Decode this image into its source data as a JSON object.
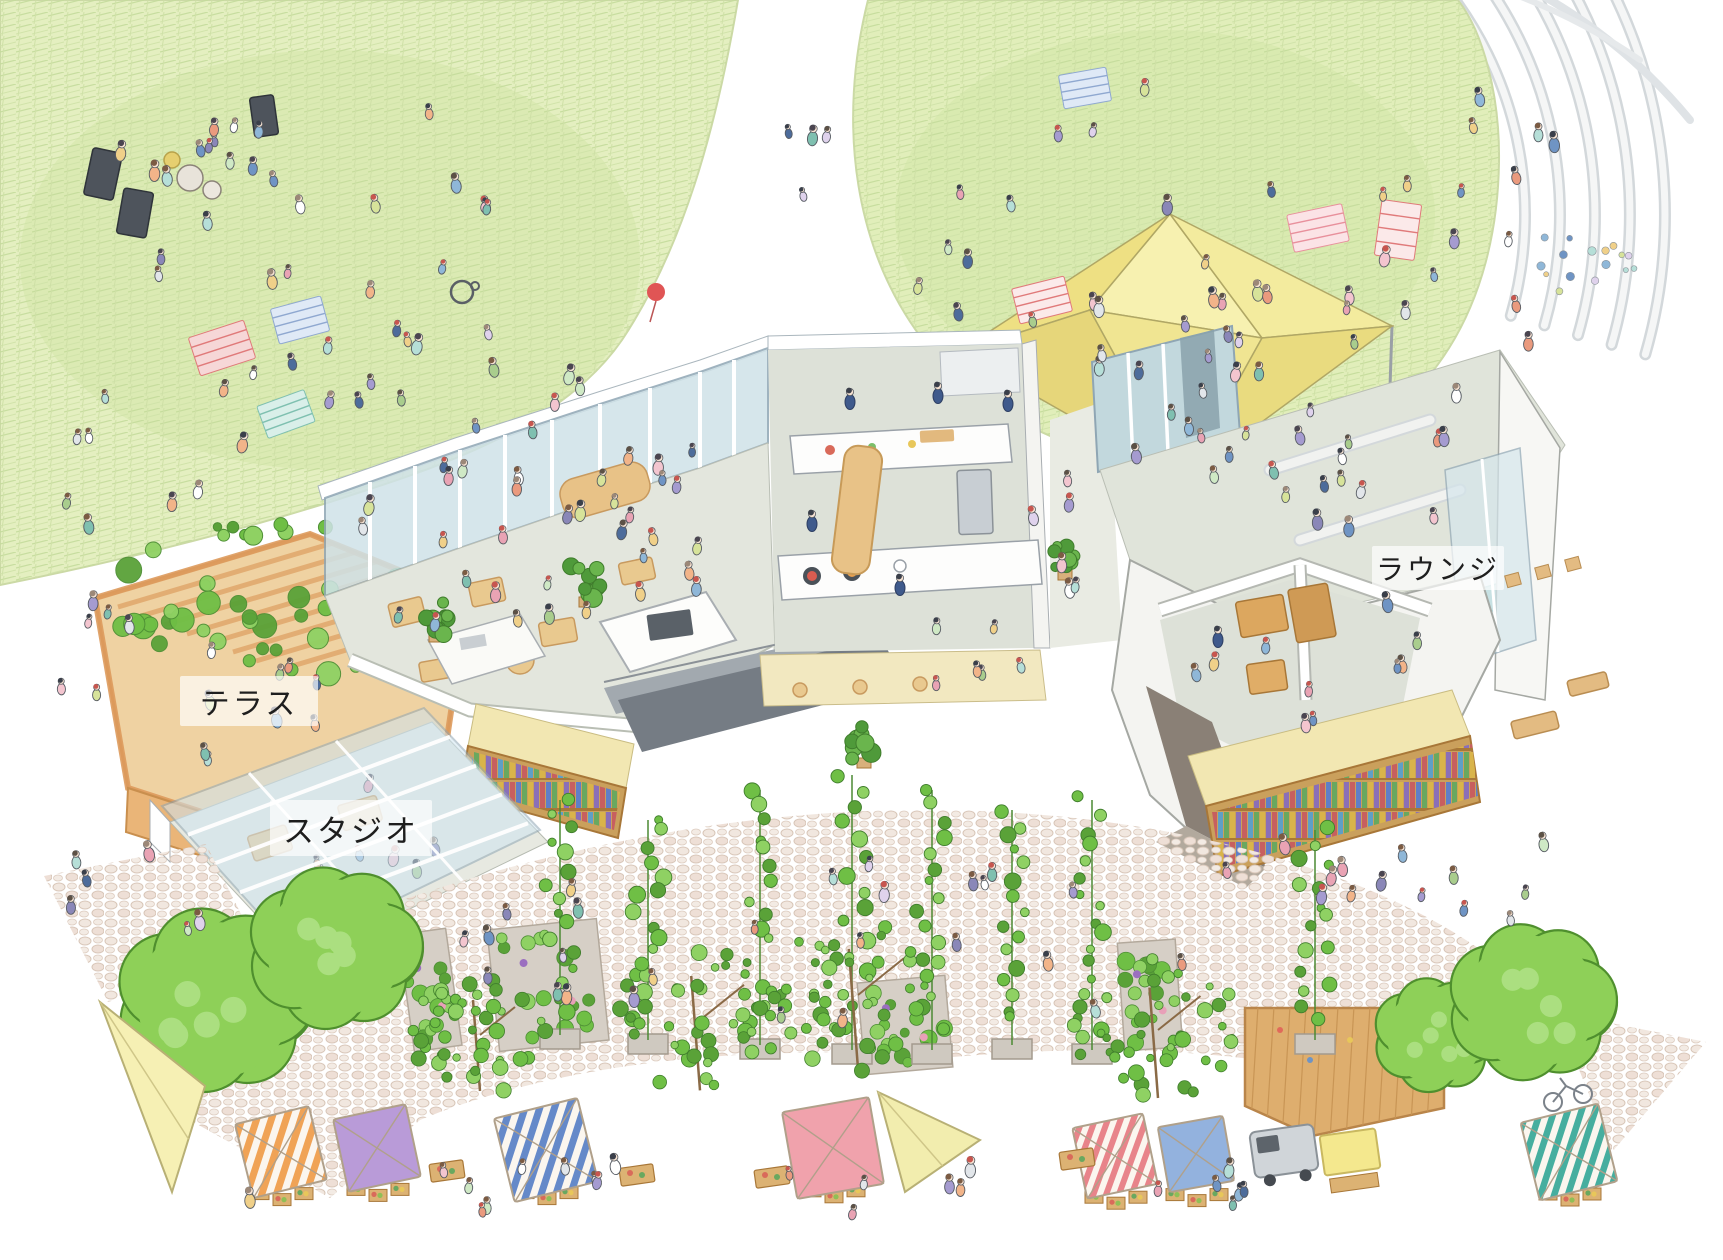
{
  "labels": {
    "terrace": "テラス",
    "studio": "スタジオ",
    "lounge": "ラウンジ"
  },
  "palette": {
    "lawn_base": "#e4efc0",
    "lawn_hatch": "#c4db9b",
    "lawn_shade": "#cde4a0",
    "tent_yellow": "#f3eb9e",
    "tent_shade": "#e9db7f",
    "tent_light": "#f8f2bc",
    "glass_blue": "#cfe2e8",
    "glass_teal": "#c2d8dd",
    "floor_gray": "#e3e6dd",
    "wood_tan": "#e9c98f",
    "pergola_orange": "#e0a76b",
    "deck_wood": "#deae6e",
    "wall_white": "#f4f4f1",
    "wall_taupe": "#8a8076",
    "ramp_gray": "#757c84",
    "fascia_cream": "#f2e7b2",
    "shelf_wood": "#caa05c",
    "cobble_stone": "#f1e7df",
    "cobble_line": "#d8c6b8",
    "tree_green": "#8ed058",
    "tree_outline": "#4f8f2e",
    "vine_green": "#6db844",
    "canopy_orange": "#f0a356",
    "canopy_purple": "#b99bd8",
    "canopy_blue": "#6589c9",
    "canopy_pink": "#f0a2ac",
    "canopy_red": "#e8848a",
    "canopy_solid_blue": "#93b2de",
    "canopy_teal": "#46ae9f",
    "canopy_yellow": "#f4e88e",
    "sail_yellow": "#f6f0b4",
    "staff_navy": "#3f5a8c",
    "skin": "#f6e2d2"
  },
  "scene": {
    "clothes_palette": [
      "#8fb7d8",
      "#e9a3b4",
      "#a9cd8d",
      "#f0d089",
      "#a59bd0",
      "#ea9a7e",
      "#6f94c4",
      "#cfe9c5",
      "#e2e6ea",
      "#b6dfd8",
      "#f3c5cf",
      "#8a87b8",
      "#d7e39a",
      "#f2b489",
      "#7fc0b0",
      "#dfd2ec",
      "#ffffff",
      "#4d6c9b"
    ],
    "hair_palette": [
      "#4a4550",
      "#3a3f4a",
      "#7b5b43",
      "#9c8878",
      "#c7564f",
      "#5c5146"
    ],
    "staff": [
      [
        850,
        402
      ],
      [
        938,
        396
      ],
      [
        1008,
        404
      ],
      [
        812,
        524
      ],
      [
        900,
        588
      ],
      [
        1218,
        640
      ]
    ],
    "people_clusters": [
      {
        "name": "lawn-left-main",
        "cx": 320,
        "cy": 300,
        "rx": 300,
        "ry": 205,
        "n": 40
      },
      {
        "name": "lawn-left-band",
        "cx": 215,
        "cy": 170,
        "rx": 95,
        "ry": 60,
        "n": 8
      },
      {
        "name": "lawn-left-edge",
        "cx": 125,
        "cy": 480,
        "rx": 100,
        "ry": 60,
        "n": 6
      },
      {
        "name": "between-lawns",
        "cx": 792,
        "cy": 140,
        "rx": 40,
        "ry": 60,
        "n": 4
      },
      {
        "name": "lawn-right",
        "cx": 1160,
        "cy": 235,
        "rx": 285,
        "ry": 160,
        "n": 30
      },
      {
        "name": "lawn-right-east",
        "cx": 1480,
        "cy": 300,
        "rx": 55,
        "ry": 115,
        "n": 7
      },
      {
        "name": "amphitheater",
        "cx": 1505,
        "cy": 180,
        "rx": 60,
        "ry": 90,
        "n": 5
      },
      {
        "name": "under-tent",
        "cx": 1175,
        "cy": 365,
        "rx": 90,
        "ry": 48,
        "n": 5
      },
      {
        "name": "tent-south",
        "cx": 1255,
        "cy": 435,
        "rx": 140,
        "ry": 48,
        "n": 8
      },
      {
        "name": "cafe-seating",
        "cx": 520,
        "cy": 565,
        "rx": 190,
        "ry": 98,
        "n": 26
      },
      {
        "name": "cafe-entry",
        "cx": 640,
        "cy": 470,
        "rx": 80,
        "ry": 40,
        "n": 6
      },
      {
        "name": "kitchen-guests",
        "cx": 960,
        "cy": 650,
        "rx": 70,
        "ry": 38,
        "n": 6
      },
      {
        "name": "passage",
        "cx": 1062,
        "cy": 520,
        "rx": 38,
        "ry": 88,
        "n": 6
      },
      {
        "name": "lounge-rooms",
        "cx": 1300,
        "cy": 645,
        "rx": 125,
        "ry": 85,
        "n": 10
      },
      {
        "name": "lounge-top",
        "cx": 1345,
        "cy": 475,
        "rx": 140,
        "ry": 66,
        "n": 14
      },
      {
        "name": "lounge-front",
        "cx": 1330,
        "cy": 880,
        "rx": 120,
        "ry": 40,
        "n": 8
      },
      {
        "name": "terrace",
        "cx": 265,
        "cy": 700,
        "rx": 115,
        "ry": 72,
        "n": 9
      },
      {
        "name": "studio",
        "cx": 345,
        "cy": 850,
        "rx": 105,
        "ry": 66,
        "n": 8,
        "slot": "people-studio-slot"
      },
      {
        "name": "studio-lower",
        "cx": 292,
        "cy": 968,
        "rx": 55,
        "ry": 32,
        "n": 5,
        "slot": "people-studio-slot"
      },
      {
        "name": "plaza-center",
        "cx": 850,
        "cy": 945,
        "rx": 420,
        "ry": 85,
        "n": 26
      },
      {
        "name": "plaza-walk",
        "cx": 770,
        "cy": 1195,
        "rx": 560,
        "ry": 45,
        "n": 22
      },
      {
        "name": "plaza-left",
        "cx": 120,
        "cy": 905,
        "rx": 88,
        "ry": 58,
        "n": 6
      },
      {
        "name": "plaza-right",
        "cx": 1510,
        "cy": 885,
        "rx": 115,
        "ry": 55,
        "n": 6
      },
      {
        "name": "west-outside",
        "cx": 92,
        "cy": 645,
        "rx": 55,
        "ry": 78,
        "n": 6
      }
    ],
    "blankets": [
      {
        "x": 222,
        "y": 348,
        "w": 58,
        "h": 40,
        "rot": -18,
        "fill": "#f6d7d7",
        "lines": "#e07a7a"
      },
      {
        "x": 300,
        "y": 320,
        "w": 52,
        "h": 36,
        "rot": -15,
        "fill": "#dfe9f6",
        "lines": "#8fa8d0"
      },
      {
        "x": 286,
        "y": 414,
        "w": 50,
        "h": 34,
        "rot": -20,
        "fill": "#d9efe9",
        "lines": "#7fc0b0"
      },
      {
        "x": 1042,
        "y": 300,
        "w": 54,
        "h": 36,
        "rot": -14,
        "fill": "#fbeaea",
        "lines": "#e07a7a"
      },
      {
        "x": 1318,
        "y": 228,
        "w": 56,
        "h": 38,
        "rot": -12,
        "fill": "#fbe3e6",
        "lines": "#e8909c"
      },
      {
        "x": 1085,
        "y": 88,
        "w": 48,
        "h": 34,
        "rot": -10,
        "fill": "#dfe9f6",
        "lines": "#8fa8d0"
      },
      {
        "x": 1398,
        "y": 230,
        "w": 40,
        "h": 56,
        "rot": 8,
        "fill": "#fbe9e9",
        "lines": "#e07a7a"
      },
      {
        "x": 1168,
        "y": 392,
        "w": 60,
        "h": 40,
        "rot": -12,
        "fill": "#fdeef0",
        "lines": "#e8909c"
      }
    ],
    "indoor_plants": [
      {
        "x": 436,
        "y": 620,
        "r": 24
      },
      {
        "x": 586,
        "y": 584,
        "r": 26
      },
      {
        "x": 864,
        "y": 744,
        "r": 28
      },
      {
        "x": 1065,
        "y": 560,
        "r": 20
      }
    ],
    "vine_walls": [
      {
        "x": 430,
        "y": 990,
        "w": 48,
        "h": 118,
        "rot": -8
      },
      {
        "x": 548,
        "y": 985,
        "w": 110,
        "h": 122,
        "rot": -6
      },
      {
        "x": 905,
        "y": 1025,
        "w": 88,
        "h": 92,
        "rot": -5
      },
      {
        "x": 1150,
        "y": 995,
        "w": 58,
        "h": 108,
        "rot": -4
      }
    ],
    "trellises": [
      {
        "x": 560,
        "t": 800,
        "b": 1045
      },
      {
        "x": 648,
        "t": 820,
        "b": 1050
      },
      {
        "x": 760,
        "t": 790,
        "b": 1055
      },
      {
        "x": 852,
        "t": 775,
        "b": 1060
      },
      {
        "x": 932,
        "t": 790,
        "b": 1060
      },
      {
        "x": 1012,
        "t": 810,
        "b": 1055
      },
      {
        "x": 1092,
        "t": 800,
        "b": 1060
      },
      {
        "x": 1315,
        "t": 830,
        "b": 1050
      }
    ],
    "trees": [
      {
        "cx": 215,
        "cy": 1000,
        "r": 100,
        "type": "bright"
      },
      {
        "cx": 335,
        "cy": 948,
        "r": 88,
        "type": "bright"
      },
      {
        "cx": 480,
        "cy": 1035,
        "r": 70,
        "type": "leafy"
      },
      {
        "cx": 700,
        "cy": 1020,
        "r": 88,
        "type": "leafy"
      },
      {
        "cx": 858,
        "cy": 995,
        "r": 92,
        "type": "leafy"
      },
      {
        "cx": 1158,
        "cy": 1030,
        "r": 85,
        "type": "leafy"
      },
      {
        "cx": 1435,
        "cy": 1035,
        "r": 62,
        "type": "bright"
      },
      {
        "cx": 1532,
        "cy": 1002,
        "r": 85,
        "type": "bright"
      }
    ],
    "stalls": [
      {
        "type": "canopy",
        "cx": 281,
        "cy": 1152,
        "w": 76,
        "rot": -14,
        "fill": "url(#stripeOrange)"
      },
      {
        "type": "canopy",
        "cx": 377,
        "cy": 1148,
        "w": 74,
        "rot": -12,
        "fill": "#b99bd8"
      },
      {
        "type": "canopy",
        "cx": 546,
        "cy": 1150,
        "w": 86,
        "rot": -14,
        "fill": "url(#stripeBlue)"
      },
      {
        "type": "canopy",
        "cx": 833,
        "cy": 1148,
        "w": 88,
        "rot": -10,
        "fill": "#f0a2ac"
      },
      {
        "type": "canopy",
        "cx": 1115,
        "cy": 1156,
        "w": 72,
        "rot": -12,
        "fill": "url(#stripeRed)"
      },
      {
        "type": "canopy",
        "cx": 1196,
        "cy": 1154,
        "w": 66,
        "rot": -10,
        "fill": "#93b2de"
      },
      {
        "type": "canopy",
        "cx": 1569,
        "cy": 1152,
        "w": 80,
        "rot": -14,
        "fill": "url(#stripeTeal)"
      },
      {
        "type": "sail",
        "pts": [
          [
            100,
            1002
          ],
          [
            205,
            1086
          ],
          [
            172,
            1192
          ]
        ],
        "fill": "#f6f0b4"
      },
      {
        "type": "sail",
        "pts": [
          [
            878,
            1092
          ],
          [
            980,
            1140
          ],
          [
            905,
            1192
          ]
        ],
        "fill": "#f2edae"
      },
      {
        "type": "truck",
        "x": 1252,
        "y": 1128
      },
      {
        "type": "stand",
        "x": 1322,
        "y": 1132
      },
      {
        "type": "table",
        "x": 430,
        "y": 1162
      },
      {
        "type": "table",
        "x": 620,
        "y": 1166
      },
      {
        "type": "table",
        "x": 755,
        "y": 1168
      },
      {
        "type": "table",
        "x": 1060,
        "y": 1150
      }
    ],
    "confetti": {
      "cx": 1595,
      "cy": 268,
      "n": 16,
      "r": 34
    }
  }
}
